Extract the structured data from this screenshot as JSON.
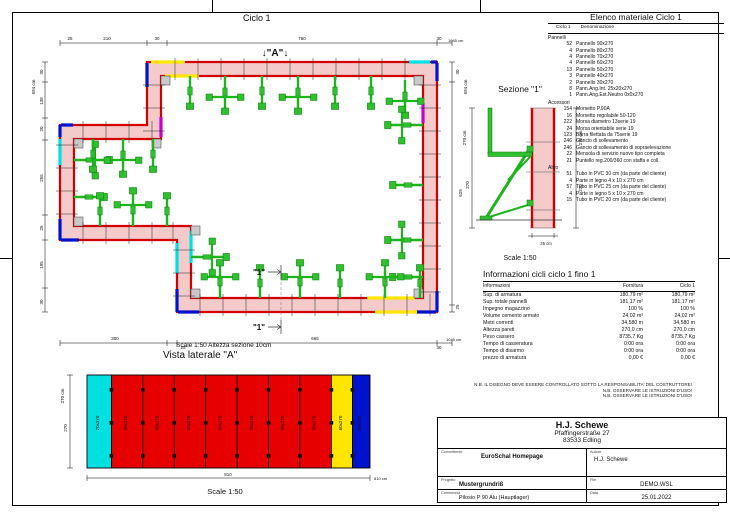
{
  "colors": {
    "wall_red": "#d40000",
    "wall_fill": "#f5caca",
    "panel_red": "#e60000",
    "yellow": "#ffe600",
    "cyan": "#00e0e0",
    "blue": "#0013cc",
    "magenta": "#cc00cc",
    "green": "#1db41d"
  },
  "plan": {
    "title": "Ciclo 1",
    "marker_a": "↓\"A\"↓",
    "section_label": "\"1\"",
    "scale_note": "Scale 1:50   Altezza sezione 10cm",
    "dims": {
      "top": [
        "25",
        "210",
        "30",
        "760",
        "30",
        "1045 cm"
      ],
      "left": [
        "694 cm",
        "30",
        "138",
        "20",
        "255",
        "25",
        "195",
        "30"
      ],
      "bottom": [
        "300",
        "25",
        "665",
        "30",
        "1045 cm"
      ],
      "right": [
        "694 cm",
        "30",
        "629",
        "25"
      ]
    }
  },
  "section": {
    "title": "Sezione \"1\"",
    "dim_left_total": "270 cm",
    "dim_left": "270",
    "dim_right_total": "270 cm",
    "dim_right": "270",
    "wall_width": "25 cm",
    "scale": "Scale 1:50"
  },
  "sideview": {
    "title": "Vista laterale \"A\"",
    "dim_height_total": "270 cm",
    "dim_height": "270",
    "dim_width": "810",
    "dim_width_total": "810 cm",
    "scale": "Scale 1:50",
    "panels": [
      {
        "label": "70x270",
        "color": "cyan"
      },
      {
        "label": "90x270",
        "color": "red"
      },
      {
        "label": "90x270",
        "color": "red"
      },
      {
        "label": "90x270",
        "color": "red"
      },
      {
        "label": "90x270",
        "color": "red"
      },
      {
        "label": "90x270",
        "color": "red"
      },
      {
        "label": "90x270",
        "color": "red"
      },
      {
        "label": "90x270",
        "color": "red"
      },
      {
        "label": "90x270",
        "color": "red"
      },
      {
        "label": "60x270",
        "color": "yellow"
      },
      {
        "label": "50x270",
        "color": "blue"
      }
    ]
  },
  "material_list": {
    "title": "Elenco materiale  Ciclo 1",
    "head_col1": "Ciclo 1",
    "head_col2": "Denominazione",
    "groups": [
      {
        "name": "Pannelli",
        "items": [
          {
            "qty": "52",
            "name": "Pannello 90x270"
          },
          {
            "qty": "4",
            "name": "Pannello 80x270"
          },
          {
            "qty": "4",
            "name": "Pannello 70x270"
          },
          {
            "qty": "4",
            "name": "Pannello 60x270"
          },
          {
            "qty": "13",
            "name": "Pannello 50x270"
          },
          {
            "qty": "3",
            "name": "Pannello 40x270"
          },
          {
            "qty": "2",
            "name": "Pannello 30x270"
          },
          {
            "qty": "8",
            "name": "Pann.Ang.Int. 25x20x270"
          },
          {
            "qty": "1",
            "name": "Pann.Ang.Est.Neutro 0x0x270"
          }
        ]
      },
      {
        "name": "Accessori",
        "items": [
          {
            "qty": "154",
            "name": "Morsetto P.90A"
          },
          {
            "qty": "16",
            "name": "Morsetto regolabile 50-120"
          },
          {
            "qty": "222",
            "name": "Morsa diametro 13serie 19"
          },
          {
            "qty": "24",
            "name": "Morsa orientabile serie 19"
          },
          {
            "qty": "123",
            "name": "Barra filettata da 75serie 19"
          },
          {
            "qty": "246",
            "name": "Gancio di sollevamento"
          },
          {
            "qty": "246",
            "name": "Gancio di sollevamento di sopraelevazione"
          },
          {
            "qty": "22",
            "name": "Mensola di servizio nuovo tipo completa"
          },
          {
            "qty": "21",
            "name": "Puntello reg.200/360 con staffa e coll."
          }
        ]
      },
      {
        "name": "Altro",
        "items": [
          {
            "qty": "51",
            "name": "Tubo in PVC 30 cm (da parte del cliente)"
          },
          {
            "qty": "4",
            "name": "Parte in legno 4 x 10 x 270 cm"
          },
          {
            "qty": "57",
            "name": "Tubo in PVC 25 cm (da parte del cliente)"
          },
          {
            "qty": "4",
            "name": "Parte in legno 5 x 10 x 270 cm"
          },
          {
            "qty": "15",
            "name": "Tubo in PVC 20 cm (da parte del cliente)"
          }
        ]
      }
    ]
  },
  "info_table": {
    "title": "Informazioni cicli  ciclo 1 fino 1",
    "headers": [
      "Informazioni",
      "Fornitura",
      "Ciclo 1"
    ],
    "rows": [
      {
        "label": "Sup. di armatura",
        "fornitura": "180,79 m²",
        "ciclo1": "180,79 m²"
      },
      {
        "label": "Sup. totale pannelli",
        "fornitura": "181,17 m²",
        "ciclo1": "181,17 m²"
      },
      {
        "label": "Impegno magazzino",
        "fornitura": "100 %",
        "ciclo1": "100 %"
      },
      {
        "label": "Volume cemento armato",
        "fornitura": "24,02 m³",
        "ciclo1": "24,02 m³"
      },
      {
        "label": "Metri correnti",
        "fornitura": "34,580 m",
        "ciclo1": "34,580 m"
      },
      {
        "label": "Altezza pareti",
        "fornitura": "270,0 cm",
        "ciclo1": "270,0 cm"
      },
      {
        "label": "Peso cassero",
        "fornitura": "8735,7 Kg",
        "ciclo1": "8735,7 Kg"
      },
      {
        "label": "Tempo di casseratura",
        "fornitura": "0:00 ora",
        "ciclo1": "0:00 ora"
      },
      {
        "label": "Tempo di disarmo",
        "fornitura": "0:00 ora",
        "ciclo1": "0:00 ora"
      },
      {
        "label": "prezzo di armatura",
        "fornitura": "0,00 €",
        "ciclo1": "0,00 €"
      }
    ]
  },
  "notes": [
    "N.B. IL DISEGNO DEVE ESSERE CONTROLLATO SOTTO LA RESPONSABILITA' DEL COSTRUTTORE!",
    "N.B. OSSERVARE LE ISTRUZIONI D'USO!",
    "N.B. OSSERVARE LE ISTRUZIONI D'USO!"
  ],
  "titleblock": {
    "company": "H.J. Schewe",
    "street": "Pfaffingerstraße 27",
    "city": "83533 Edling",
    "committente_label": "Committente",
    "committente": "EuroSchal Homepage",
    "autore_label": "Autore",
    "autore": "H.J. Schewe",
    "progetto_label": "Progetto",
    "progetto": "Mustergrundriß",
    "file_label": "File",
    "file": "DEMO.WSL",
    "commessa_label": "Commessa",
    "commessa": "Pilosio P 90 Alu (Hauptlager)",
    "data_label": "Data",
    "data": "25.01.2022"
  }
}
